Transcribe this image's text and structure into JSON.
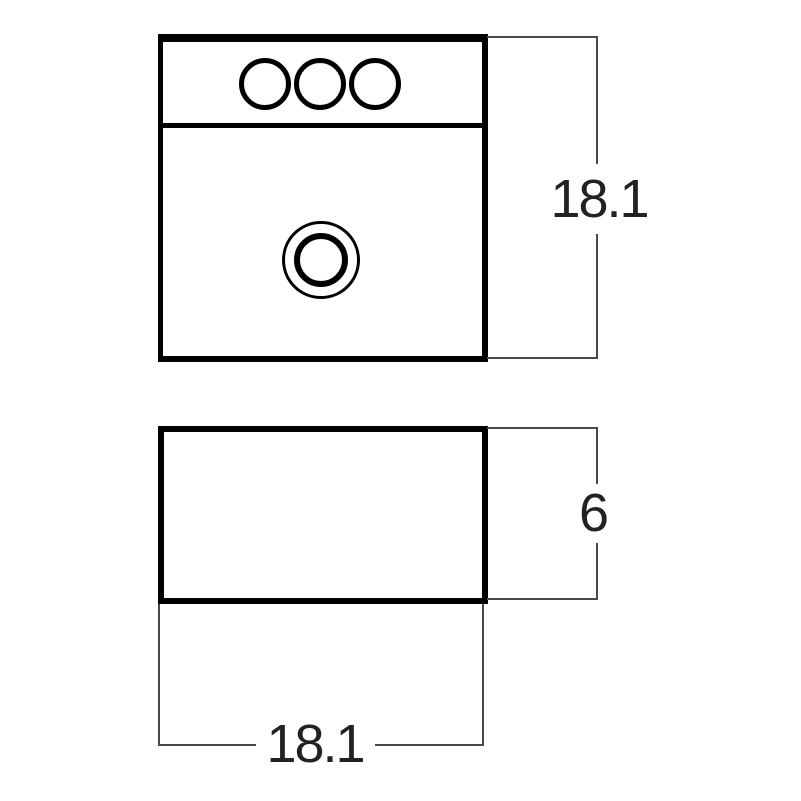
{
  "diagram": {
    "type": "technical-dimension-drawing",
    "subject": "vessel-sink",
    "colors": {
      "background": "#ffffff",
      "outline": "#000000",
      "dimension_line": "#4a4a4a",
      "label_text": "#222222"
    },
    "top_view": {
      "faucet_hole_count": 3,
      "height_label": "18.1"
    },
    "front_view": {
      "height_label": "6",
      "width_label": "18.1"
    }
  }
}
